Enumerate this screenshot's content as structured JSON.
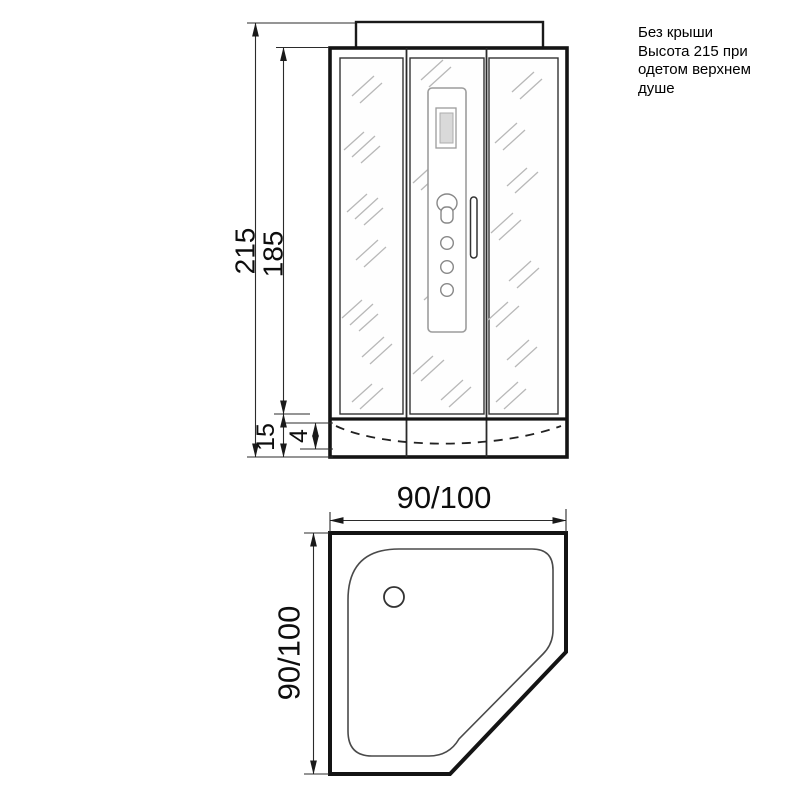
{
  "note": {
    "text": "Без крыши\nВысота 215 при\nодетом верхнем\nдуше"
  },
  "front_view": {
    "dim_total_height": "215",
    "dim_glass_height": "185",
    "dim_tray_height": "15",
    "dim_tray_depth": "4"
  },
  "top_view": {
    "dim_width": "90/100",
    "dim_depth": "90/100"
  }
}
